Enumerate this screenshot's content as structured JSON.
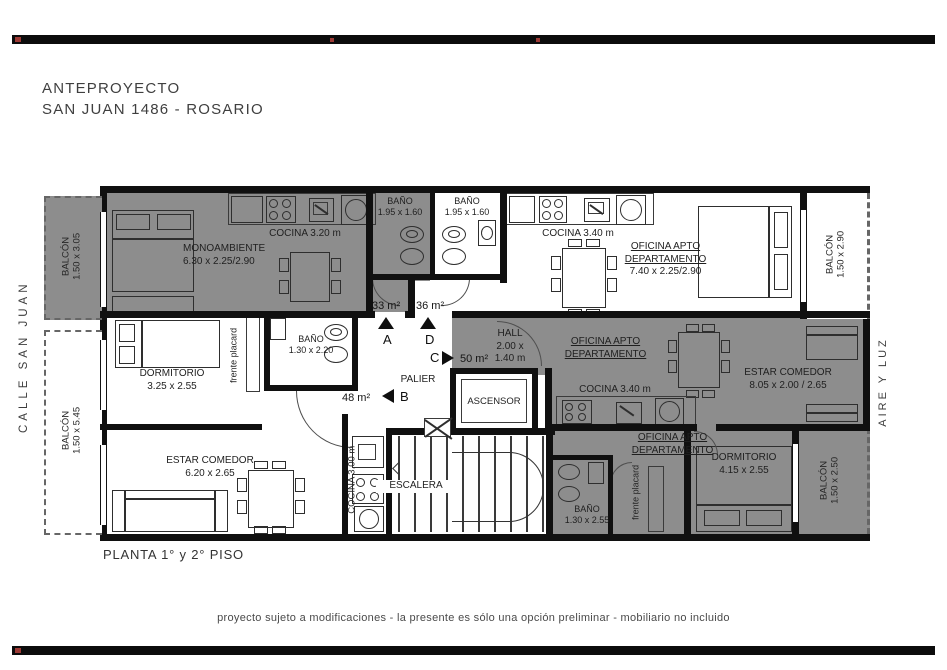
{
  "frame": {
    "title_line1": "ANTEPROYECTO",
    "title_line2": "SAN JUAN 1486 - ROSARIO",
    "plan_caption": "PLANTA 1° y 2° PISO",
    "footer_note": "proyecto sujeto a modificaciones - la presente es sólo una opción preliminar - mobiliario no incluido",
    "street_label": "CALLE SAN JUAN",
    "light_air_label": "AIRE Y LUZ"
  },
  "balconies": {
    "top_left": {
      "name": "BALCÓN",
      "size": "1.50 x 3.05"
    },
    "bottom_left": {
      "name": "BALCÓN",
      "size": "1.50 x 5.45"
    },
    "top_right": {
      "name": "BALCÓN",
      "size": "1.50 x 2.90"
    },
    "bottom_right": {
      "name": "BALCÓN",
      "size": "1.50 x 2.50"
    }
  },
  "unit_a": {
    "cocina": "COCINA 3.20 m",
    "room": "MONOAMBIENTE",
    "room_size": "6.30 x 2.25/2.90",
    "bano": "BAÑO",
    "bano_size": "1.95 x 1.60",
    "area": "33 m²",
    "letter": "A"
  },
  "unit_d": {
    "bano": "BAÑO",
    "bano_size": "1.95 x 1.60",
    "cocina": "COCINA 3.40 m",
    "room_line1": "OFICINA APTO",
    "room_line2": "DEPARTAMENTO",
    "room_size": "7.40 x 2.25/2.90",
    "area": "36 m²",
    "letter": "D"
  },
  "unit_b": {
    "dormitorio": "DORMITORIO",
    "dormitorio_size": "3.25 x 2.55",
    "bano": "BAÑO",
    "bano_size": "1.30 x 2.20",
    "placard": "frente placard",
    "estar": "ESTAR COMEDOR",
    "estar_size": "6.20 x 2.65",
    "cocina": "COCINA 3.00 m",
    "area": "48 m²",
    "letter": "B"
  },
  "unit_c": {
    "oficina_line1": "OFICINA APTO",
    "oficina_line2": "DEPARTAMENTO",
    "cocina": "COCINA 3.40 m",
    "estar": "ESTAR COMEDOR",
    "estar_size": "8.05 x 2.00 / 2.65",
    "oficina2_line1": "OFICINA APTO",
    "oficina2_line2": "DEPARTAMENTO",
    "dormitorio": "DORMITORIO",
    "dormitorio_size": "4.15 x 2.55",
    "bano": "BAÑO",
    "bano_size": "1.30 x 2.55",
    "placard": "frente placard",
    "area": "50 m²",
    "letter": "C"
  },
  "core": {
    "hall": "HALL",
    "hall_size_line1": "2.00 x",
    "hall_size_line2": "1.40 m",
    "palier": "PALIER",
    "ascensor": "ASCENSOR",
    "escalera": "ESCALERA"
  },
  "colors": {
    "room_gray": "#8d8d8d",
    "wall_black": "#101010",
    "mark_red": "#9c3a35"
  }
}
